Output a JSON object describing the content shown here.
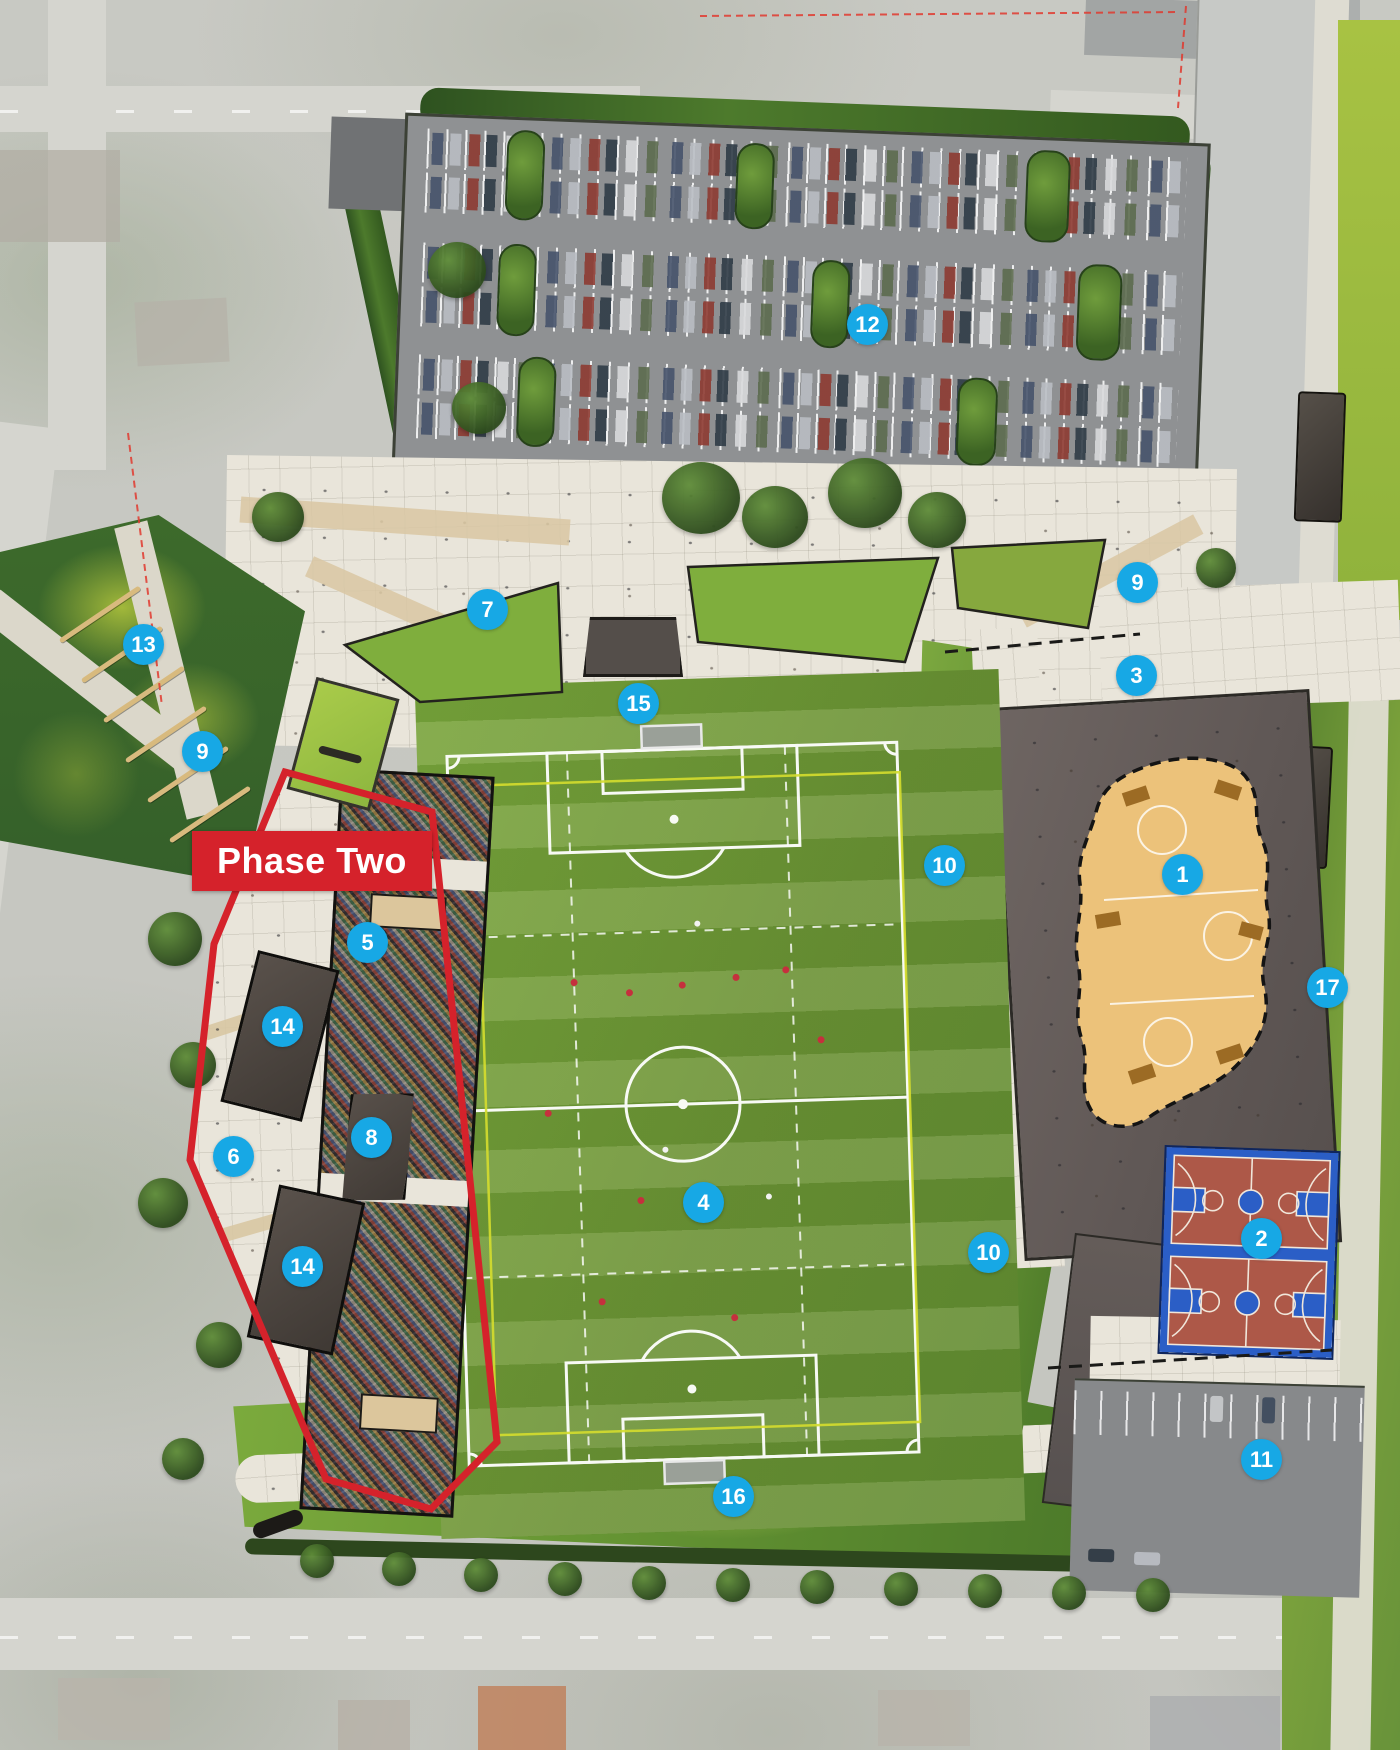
{
  "phase_banner": {
    "label": "Phase Two"
  },
  "markers": [
    {
      "id": "1",
      "label": "1",
      "area": "wood-sport-court"
    },
    {
      "id": "2",
      "label": "2",
      "area": "basketball-courts"
    },
    {
      "id": "3",
      "label": "3",
      "area": "east-plaza-edge"
    },
    {
      "id": "4",
      "label": "4",
      "area": "soccer-field"
    },
    {
      "id": "5",
      "label": "5",
      "area": "west-stands-north"
    },
    {
      "id": "6",
      "label": "6",
      "area": "west-promenade"
    },
    {
      "id": "7",
      "label": "7",
      "area": "north-promenade"
    },
    {
      "id": "8",
      "label": "8",
      "area": "west-stands-planter"
    },
    {
      "id": "9",
      "label": "9",
      "area": "left-park-path"
    },
    {
      "id": "9",
      "label": "9",
      "area": "northeast-walk"
    },
    {
      "id": "10",
      "label": "10",
      "area": "east-lawn-north"
    },
    {
      "id": "10",
      "label": "10",
      "area": "east-lawn-south"
    },
    {
      "id": "11",
      "label": "11",
      "area": "southeast-parking"
    },
    {
      "id": "12",
      "label": "12",
      "area": "north-parking-lot"
    },
    {
      "id": "13",
      "label": "13",
      "area": "left-park"
    },
    {
      "id": "14",
      "label": "14",
      "area": "planter-north"
    },
    {
      "id": "14",
      "label": "14",
      "area": "planter-south"
    },
    {
      "id": "15",
      "label": "15",
      "area": "central-promenade"
    },
    {
      "id": "16",
      "label": "16",
      "area": "south-walkway"
    },
    {
      "id": "17",
      "label": "17",
      "area": "east-green-corridor"
    }
  ],
  "colors": {
    "marker_blue": "#17a8e5",
    "phase_red": "#d5222b",
    "field_green": "#76a23a",
    "wood_court": "#ecc27a",
    "court_red": "#ad5848",
    "court_blue": "#2b5ec6",
    "plaza_paving": "#e9e5da",
    "dark_plaza": "#5f5755"
  }
}
